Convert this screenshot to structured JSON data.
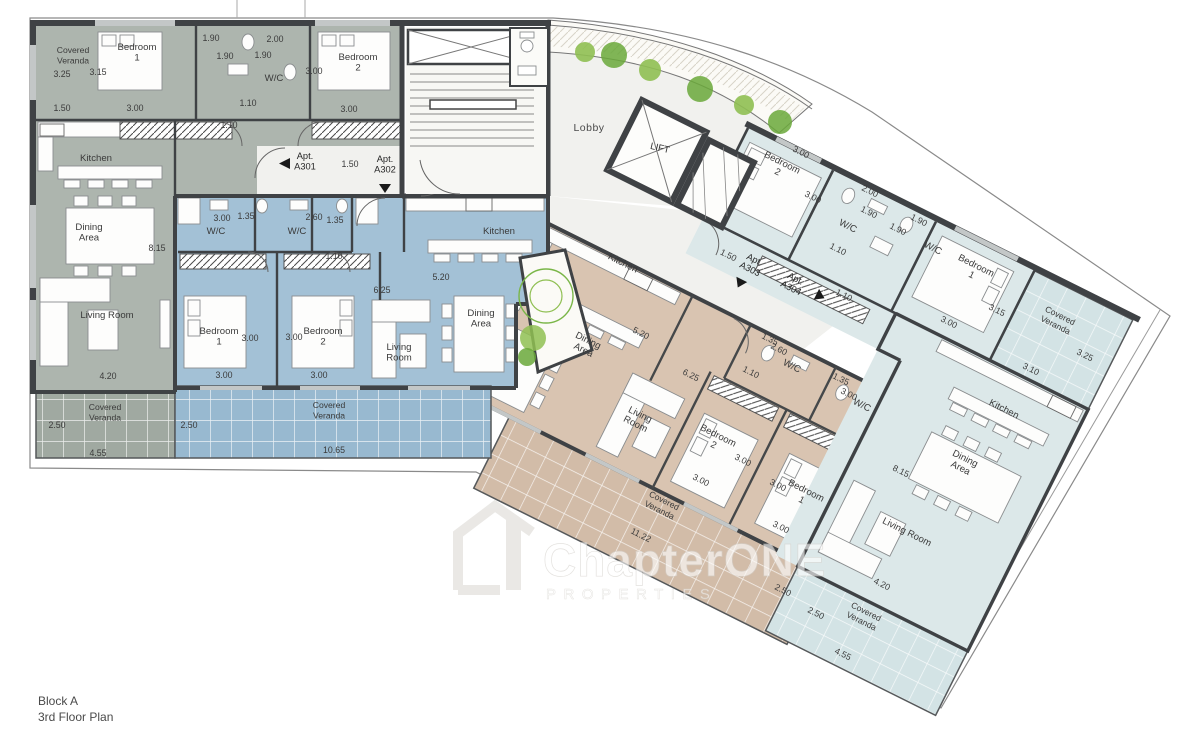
{
  "plan": {
    "block": "Block A",
    "floor": "3rd Floor Plan"
  },
  "watermark": {
    "brand": "ChapterONE",
    "tagline": "PROPERTIES"
  },
  "common": {
    "lobby": "Lobby",
    "lift": "LIFT"
  },
  "corridor": {
    "a301_label": "Apt.\nA301",
    "a302_label": "Apt.\nA302",
    "a303_label": "Apt.\nA303",
    "a304_label": "Apt.\nA304",
    "dim_left": "1.50",
    "dim_right": "1.50"
  },
  "apartments": {
    "a301": {
      "rooms": {
        "veranda_top": "Covered\nVeranda",
        "bedroom1": "Bedroom\n1",
        "wc": "W/C",
        "bedroom2": "Bedroom\n2",
        "kitchen": "Kitchen",
        "dining": "Dining\nArea",
        "living": "Living Room",
        "veranda_bottom": "Covered\nVeranda"
      },
      "dims": [
        "3.25",
        "3.15",
        "1.90",
        "2.00",
        "1.90",
        "1.90",
        "3.00",
        "1.50",
        "3.00",
        "1.10",
        "1.10",
        "3.00",
        "8.15",
        "4.20",
        "2.50",
        "4.55"
      ]
    },
    "a302": {
      "rooms": {
        "wc1": "W/C",
        "wc2": "W/C",
        "kitchen": "Kitchen",
        "bedroom1": "Bedroom\n1",
        "bedroom2": "Bedroom\n2",
        "living": "Living\nRoom",
        "dining": "Dining\nArea",
        "veranda": "Covered\nVeranda"
      },
      "dims": [
        "3.00",
        "1.35",
        "2.60",
        "1.35",
        "1.10",
        "5.20",
        "6.25",
        "3.00",
        "3.00",
        "3.00",
        "3.00",
        "2.50",
        "10.65"
      ]
    },
    "a303": {
      "rooms": {
        "kitchen": "Kitchen",
        "dining": "Dining\nArea",
        "living": "Living\nRoom",
        "wc1": "W/C",
        "wc2": "W/C",
        "bedroom2": "Bedroom\n2",
        "bedroom1": "Bedroom\n1",
        "veranda": "Covered\nVeranda"
      },
      "dims": [
        "5.20",
        "6.25",
        "1.10",
        "1.35",
        "2.60",
        "1.35",
        "3.00",
        "3.00",
        "3.00",
        "3.00",
        "3.00",
        "11.22",
        "2.50"
      ]
    },
    "a304": {
      "rooms": {
        "bedroom2": "Bedroom\n2",
        "wc1": "W/C",
        "wc2": "W/C",
        "bedroom1": "Bedroom\n1",
        "veranda_top": "Covered\nVeranda",
        "kitchen": "Kitchen",
        "dining": "Dining\nArea",
        "living": "Living Room",
        "veranda_bottom": "Covered\nVeranda"
      },
      "dims": [
        "3.00",
        "3.00",
        "2.00",
        "1.90",
        "1.90",
        "1.90",
        "1.10",
        "1.10",
        "3.15",
        "3.00",
        "3.25",
        "3.10",
        "8.15",
        "4.20",
        "2.50",
        "4.55"
      ]
    }
  },
  "colors": {
    "a301": "#adb5ae",
    "a302": "#a3c1d6",
    "a303": "#d9c4b1",
    "a304": "#dce8e9",
    "walls": "#3f4245",
    "plants": "#8fbf52",
    "corridor": "#f1f1ee"
  }
}
